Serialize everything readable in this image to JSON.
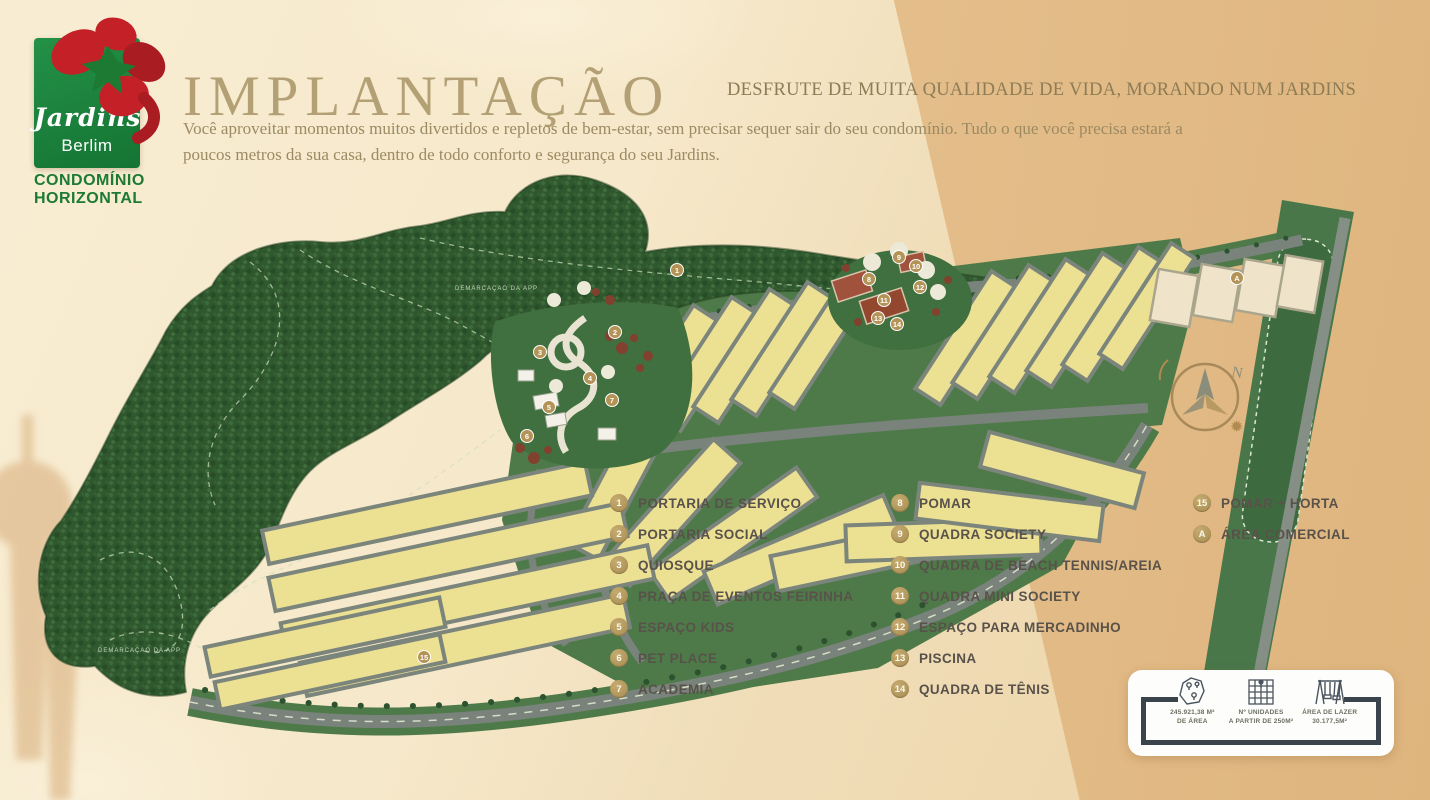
{
  "logo": {
    "brand_script": "Jardins",
    "brand_sub": "Berlim",
    "tagline_line1": "CONDOMÍNIO",
    "tagline_line2": "HORIZONTAL"
  },
  "header": {
    "title": "IMPLANTAÇÃO",
    "subtitle": "DESFRUTE DE MUITA QUALIDADE DE VIDA, MORANDO NUM JARDINS",
    "body_line1": "Você aproveitar momentos muitos divertidos e repletos de bem-estar, sem precisar sequer sair do seu condomínio. Tudo o que você precisa estará a",
    "body_line2": "poucos metros da sua casa, dentro de todo conforto e segurança do seu Jardins."
  },
  "legend": {
    "columns": [
      [
        {
          "num": "1",
          "label": "PORTARIA DE SERVIÇO"
        },
        {
          "num": "2",
          "label": "PORTARIA SOCIAL"
        },
        {
          "num": "3",
          "label": "QUIOSQUE"
        },
        {
          "num": "4",
          "label": "PRAÇA DE EVENTOS FEIRINHA"
        },
        {
          "num": "5",
          "label": "ESPAÇO KIDS"
        },
        {
          "num": "6",
          "label": "PET PLACE"
        },
        {
          "num": "7",
          "label": "ACADEMIA"
        }
      ],
      [
        {
          "num": "8",
          "label": "POMAR"
        },
        {
          "num": "9",
          "label": "QUADRA SOCIETY"
        },
        {
          "num": "10",
          "label": "QUADRA DE BEACH TENNIS/AREIA"
        },
        {
          "num": "11",
          "label": "QUADRA MINI SOCIETY"
        },
        {
          "num": "12",
          "label": "ESPAÇO PARA MERCADINHO"
        },
        {
          "num": "13",
          "label": "PISCINA"
        },
        {
          "num": "14",
          "label": "QUADRA DE TÊNIS"
        }
      ],
      [
        {
          "num": "15",
          "label": "POMAR + HORTA"
        },
        {
          "num": "A",
          "label": "ÁREA COMERCIAL"
        }
      ]
    ]
  },
  "map": {
    "compass_n": "N",
    "app_label_1": "DEMARCAÇÃO DA APP",
    "app_label_2": "DEMARCAÇÃO DA APP",
    "markers": [
      "1",
      "2",
      "3",
      "4",
      "5",
      "6",
      "7",
      "8",
      "9",
      "10",
      "11",
      "12",
      "13",
      "14",
      "15",
      "A"
    ]
  },
  "info_card": {
    "items": [
      {
        "icon": "site-area-map-icon",
        "line1": "245.921,38 M²",
        "line2": "DE ÁREA"
      },
      {
        "icon": "units-grid-icon",
        "line1": "Nº UNIDADES",
        "line2": "A PARTIR DE 250M²"
      },
      {
        "icon": "playground-swing-icon",
        "line1": "ÁREA DE LAZER",
        "line2": "30.177,5M²"
      }
    ]
  },
  "colors": {
    "accent_gold": "#b3a074",
    "legend_circle": "#ab9157",
    "forest_green": "#30582f",
    "lot_yellow": "#ece093",
    "logo_green": "#1c7a33",
    "logo_red": "#c32127",
    "road_gray": "#79837b"
  }
}
